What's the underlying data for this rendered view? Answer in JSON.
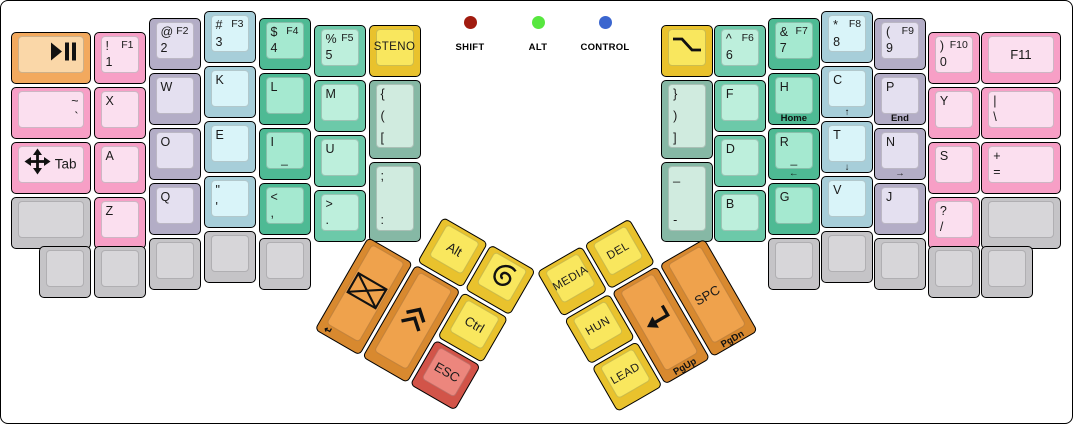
{
  "canvas": {
    "width": 1073,
    "height": 424,
    "bg": "#ffffff",
    "border": "#000000"
  },
  "palette": {
    "pink": {
      "side": "#f79fc6",
      "top": "#fbdfef"
    },
    "lavender": {
      "side": "#b3adc6",
      "top": "#e4e0f0"
    },
    "blue": {
      "side": "#a7ced9",
      "top": "#d9f4f9"
    },
    "green_dark": {
      "side": "#4eba94",
      "top": "#a5e9d0"
    },
    "green_light": {
      "side": "#6cc9a9",
      "top": "#bdefdc"
    },
    "mint": {
      "side": "#86b8a5",
      "top": "#d0ebdf"
    },
    "yellow": {
      "side": "#e9c22d",
      "top": "#f9e75e"
    },
    "orange_light": {
      "side": "#f2a95e",
      "top": "#fad7a8"
    },
    "orange": {
      "side": "#d8892f",
      "top": "#efa24c"
    },
    "salmon": {
      "side": "#d25449",
      "top": "#ec867d"
    },
    "gray": {
      "side": "#c5c4c7",
      "top": "#d7d6d9"
    }
  },
  "indicators": [
    {
      "label": "SHIFT",
      "color": "#a11b0f",
      "x": 469
    },
    {
      "label": "ALT",
      "color": "#57e73f",
      "x": 537
    },
    {
      "label": "CONTROL",
      "color": "#3b66cf",
      "x": 604
    }
  ],
  "keyboard": {
    "unit": 55,
    "origin": [
      10,
      10
    ],
    "main_keys": [
      {
        "name": "key-play-pause",
        "x": 0,
        "y": 0.375,
        "w": 1.5,
        "color": "orange_light",
        "icon": "play-pause",
        "icon_align": "right"
      },
      {
        "name": "key-1-f1",
        "x": 1.5,
        "y": 0.375,
        "tl": "!",
        "tr": "F1",
        "bl": "1",
        "color": "pink"
      },
      {
        "name": "key-2-f2",
        "x": 2.5,
        "y": 0.125,
        "tl": "@",
        "tr": "F2",
        "bl": "2",
        "color": "lavender"
      },
      {
        "name": "key-3-f3",
        "x": 3.5,
        "y": 0,
        "tl": "#",
        "tr": "F3",
        "bl": "3",
        "color": "blue"
      },
      {
        "name": "key-4-f4",
        "x": 4.5,
        "y": 0.125,
        "tl": "$",
        "tr": "F4",
        "bl": "4",
        "color": "green_dark"
      },
      {
        "name": "key-5-f5",
        "x": 5.5,
        "y": 0.25,
        "tl": "%",
        "tr": "F5",
        "bl": "5",
        "color": "green_light"
      },
      {
        "name": "key-steno",
        "x": 6.5,
        "y": 0.25,
        "center": "STENO",
        "color": "yellow"
      },
      {
        "name": "key-tilde-grave",
        "x": 0,
        "y": 1.375,
        "w": 1.5,
        "tr_big": "~",
        "br": "`",
        "color": "pink"
      },
      {
        "name": "key-x",
        "x": 1.5,
        "y": 1.375,
        "tl": "X",
        "color": "pink"
      },
      {
        "name": "key-w",
        "x": 2.5,
        "y": 1.125,
        "tl": "W",
        "color": "lavender"
      },
      {
        "name": "key-k",
        "x": 3.5,
        "y": 1,
        "tl": "K",
        "color": "blue"
      },
      {
        "name": "key-l",
        "x": 4.5,
        "y": 1.125,
        "tl": "L",
        "color": "green_dark"
      },
      {
        "name": "key-m",
        "x": 5.5,
        "y": 1.25,
        "tl": "M",
        "color": "green_light"
      },
      {
        "name": "key-open-brackets",
        "x": 6.5,
        "y": 1.25,
        "h": 1.5,
        "tl": "{",
        "ml": "(",
        "bl": "[",
        "color": "mint"
      },
      {
        "name": "key-tab",
        "x": 0,
        "y": 2.375,
        "w": 1.5,
        "icon": "move",
        "icon_align": "left",
        "mr": "Tab",
        "color": "pink"
      },
      {
        "name": "key-a",
        "x": 1.5,
        "y": 2.375,
        "tl": "A",
        "color": "pink"
      },
      {
        "name": "key-o",
        "x": 2.5,
        "y": 2.125,
        "tl": "O",
        "color": "lavender"
      },
      {
        "name": "key-e",
        "x": 3.5,
        "y": 2,
        "tl": "E",
        "color": "blue"
      },
      {
        "name": "key-i",
        "x": 4.5,
        "y": 2.125,
        "tl": "I",
        "home": true,
        "color": "green_dark"
      },
      {
        "name": "key-u",
        "x": 5.5,
        "y": 2.25,
        "tl": "U",
        "color": "green_light"
      },
      {
        "name": "key-semicolon-colon",
        "x": 6.5,
        "y": 2.75,
        "h": 1.5,
        "tl": ";",
        "bl": ":",
        "color": "mint"
      },
      {
        "name": "key-blank-left",
        "x": 0,
        "y": 3.375,
        "w": 1.5,
        "color": "gray"
      },
      {
        "name": "key-z",
        "x": 1.5,
        "y": 3.375,
        "tl": "Z",
        "color": "pink"
      },
      {
        "name": "key-q",
        "x": 2.5,
        "y": 3.125,
        "tl": "Q",
        "color": "lavender"
      },
      {
        "name": "key-quote",
        "x": 3.5,
        "y": 3,
        "tl": "\"",
        "bl": "'",
        "color": "blue"
      },
      {
        "name": "key-comma",
        "x": 4.5,
        "y": 3.125,
        "tl": "<",
        "bl": ",",
        "color": "green_dark"
      },
      {
        "name": "key-period",
        "x": 5.5,
        "y": 3.25,
        "tl": ">",
        "bl": ".",
        "color": "green_light"
      },
      {
        "name": "key-blank-bl-1",
        "x": 0.5,
        "y": 4.27,
        "color": "gray"
      },
      {
        "name": "key-blank-bl-2",
        "x": 1.5,
        "y": 4.27,
        "color": "gray"
      },
      {
        "name": "key-blank-bl-3",
        "x": 2.5,
        "y": 4.125,
        "color": "gray"
      },
      {
        "name": "key-blank-bl-4",
        "x": 3.5,
        "y": 4.0,
        "color": "gray"
      },
      {
        "name": "key-blank-bl-5",
        "x": 4.5,
        "y": 4.125,
        "color": "gray"
      },
      {
        "name": "key-option",
        "x": 11.82,
        "y": 0.25,
        "icon": "option",
        "color": "yellow"
      },
      {
        "name": "key-6-f6",
        "x": 12.78,
        "y": 0.25,
        "tl": "^",
        "tr": "F6",
        "bl": "6",
        "color": "green_light"
      },
      {
        "name": "key-7-f7",
        "x": 13.76,
        "y": 0.125,
        "tl": "&",
        "tr": "F7",
        "bl": "7",
        "color": "green_dark"
      },
      {
        "name": "key-8-f8",
        "x": 14.73,
        "y": 0,
        "tl": "*",
        "tr": "F8",
        "bl": "8",
        "color": "blue"
      },
      {
        "name": "key-9-f9",
        "x": 15.69,
        "y": 0.125,
        "tl": "(",
        "tr": "F9",
        "bl": "9",
        "color": "lavender"
      },
      {
        "name": "key-0-f10",
        "x": 16.67,
        "y": 0.375,
        "tl": ")",
        "tr": "F10",
        "bl": "0",
        "color": "pink"
      },
      {
        "name": "key-f11",
        "x": 17.64,
        "y": 0.375,
        "w": 1.5,
        "center": "F11",
        "center_big": true,
        "color": "pink"
      },
      {
        "name": "key-close-brackets",
        "x": 11.82,
        "y": 1.25,
        "h": 1.5,
        "tl": "}",
        "ml": ")",
        "bl": "]",
        "color": "mint"
      },
      {
        "name": "key-f",
        "x": 12.78,
        "y": 1.25,
        "tl": "F",
        "color": "green_light"
      },
      {
        "name": "key-h",
        "x": 13.76,
        "y": 1.125,
        "tl": "H",
        "front": "Home",
        "color": "green_dark"
      },
      {
        "name": "key-c",
        "x": 14.73,
        "y": 1,
        "tl": "C",
        "front": "↑",
        "color": "blue"
      },
      {
        "name": "key-p",
        "x": 15.69,
        "y": 1.125,
        "tl": "P",
        "front": "End",
        "color": "lavender"
      },
      {
        "name": "key-y",
        "x": 16.67,
        "y": 1.375,
        "tl": "Y",
        "color": "pink"
      },
      {
        "name": "key-pipe-backslash",
        "x": 17.64,
        "y": 1.375,
        "w": 1.5,
        "tl": "|",
        "bl": "\\",
        "color": "pink"
      },
      {
        "name": "key-d",
        "x": 12.78,
        "y": 2.25,
        "tl": "D",
        "color": "green_light"
      },
      {
        "name": "key-r",
        "x": 13.76,
        "y": 2.125,
        "tl": "R",
        "home": true,
        "front": "←",
        "color": "green_dark"
      },
      {
        "name": "key-t",
        "x": 14.73,
        "y": 2,
        "tl": "T",
        "front": "↓",
        "color": "blue"
      },
      {
        "name": "key-n",
        "x": 15.69,
        "y": 2.125,
        "tl": "N",
        "front": "→",
        "color": "lavender"
      },
      {
        "name": "key-s",
        "x": 16.67,
        "y": 2.375,
        "tl": "S",
        "color": "pink"
      },
      {
        "name": "key-plus-equals",
        "x": 17.64,
        "y": 2.375,
        "w": 1.5,
        "tl": "+",
        "bl": "=",
        "color": "pink"
      },
      {
        "name": "key-underscore-dash",
        "x": 11.82,
        "y": 2.75,
        "h": 1.5,
        "tl": "_",
        "bl": "-",
        "color": "mint"
      },
      {
        "name": "key-b",
        "x": 12.78,
        "y": 3.25,
        "tl": "B",
        "color": "green_light"
      },
      {
        "name": "key-g",
        "x": 13.76,
        "y": 3.125,
        "tl": "G",
        "color": "green_dark"
      },
      {
        "name": "key-v",
        "x": 14.73,
        "y": 3,
        "tl": "V",
        "color": "blue"
      },
      {
        "name": "key-j",
        "x": 15.69,
        "y": 3.125,
        "tl": "J",
        "color": "lavender"
      },
      {
        "name": "key-question-slash",
        "x": 16.67,
        "y": 3.375,
        "tl": "?",
        "bl": "/",
        "color": "pink"
      },
      {
        "name": "key-blank-right",
        "x": 17.64,
        "y": 3.375,
        "w": 1.5,
        "color": "gray"
      },
      {
        "name": "key-blank-br-1",
        "x": 13.76,
        "y": 4.125,
        "color": "gray"
      },
      {
        "name": "key-blank-br-2",
        "x": 14.73,
        "y": 4.0,
        "color": "gray"
      },
      {
        "name": "key-blank-br-3",
        "x": 15.69,
        "y": 4.125,
        "color": "gray"
      },
      {
        "name": "key-blank-br-4",
        "x": 16.67,
        "y": 4.27,
        "color": "gray"
      },
      {
        "name": "key-blank-br-5",
        "x": 17.64,
        "y": 4.27,
        "color": "gray"
      }
    ],
    "thumb_clusters": [
      {
        "name": "left-thumb-cluster",
        "anchor": [
          367,
          236
        ],
        "rotation": 30,
        "keys": [
          {
            "name": "key-alt",
            "x": 1,
            "y": -1,
            "center": "Alt",
            "center_big": true,
            "color": "yellow"
          },
          {
            "name": "key-debian",
            "x": 2,
            "y": -1,
            "icon": "swirl",
            "color": "yellow"
          },
          {
            "name": "key-mail-enter",
            "x": 0,
            "y": 0,
            "h": 2,
            "icon": "envelope",
            "front": "↵",
            "front_align": "left",
            "color": "orange"
          },
          {
            "name": "key-page-up-chevrons",
            "x": 1,
            "y": 0,
            "h": 2,
            "icon": "double-chevron-up",
            "color": "orange"
          },
          {
            "name": "key-ctrl",
            "x": 2,
            "y": 0,
            "center": "Ctrl",
            "center_big": true,
            "color": "yellow"
          },
          {
            "name": "key-esc",
            "x": 2,
            "y": 1,
            "center": "ESC",
            "center_big": true,
            "color": "salmon"
          }
        ]
      },
      {
        "name": "right-thumb-cluster",
        "anchor": [
          706,
          236
        ],
        "rotation": -30,
        "keys": [
          {
            "name": "key-media",
            "x": -3,
            "y": -1,
            "center": "MEDIA",
            "color": "yellow"
          },
          {
            "name": "key-del",
            "x": -2,
            "y": -1,
            "center": "DEL",
            "color": "yellow"
          },
          {
            "name": "key-hun",
            "x": -3,
            "y": 0,
            "center": "HUN",
            "color": "yellow"
          },
          {
            "name": "key-enter",
            "x": -2,
            "y": 0,
            "h": 2,
            "icon": "return-arrow",
            "front": "PgUp",
            "color": "orange"
          },
          {
            "name": "key-space",
            "x": -1,
            "y": 0,
            "h": 2,
            "center": "SPC",
            "center_big": true,
            "front": "PgDn",
            "color": "orange"
          },
          {
            "name": "key-lead",
            "x": -3,
            "y": 1,
            "center": "LEAD",
            "color": "yellow"
          }
        ]
      }
    ]
  }
}
